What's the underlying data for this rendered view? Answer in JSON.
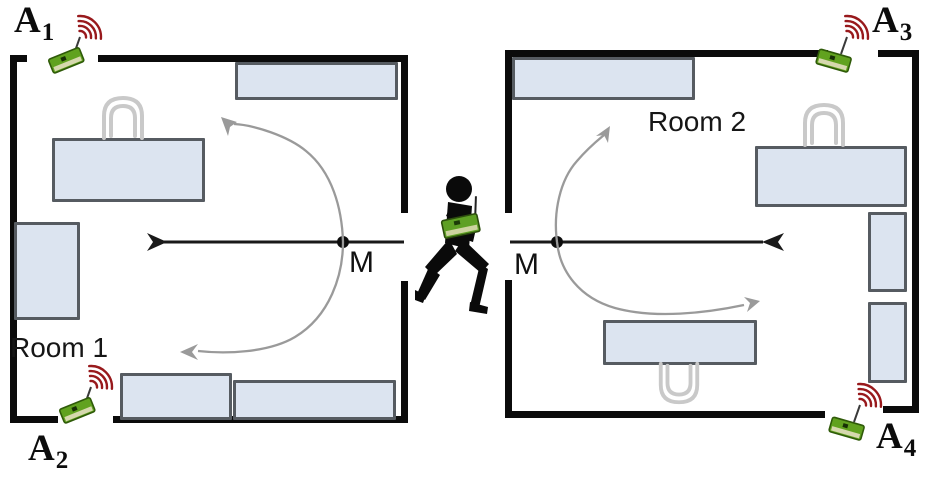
{
  "rooms": [
    {
      "label": "Room 1"
    },
    {
      "label": "Room 2"
    }
  ],
  "anchors": [
    {
      "name": "A1",
      "label": "A",
      "sub": "1"
    },
    {
      "name": "A2",
      "label": "A",
      "sub": "2"
    },
    {
      "name": "A3",
      "label": "A",
      "sub": "3"
    },
    {
      "name": "A4",
      "label": "A",
      "sub": "4"
    }
  ],
  "measurement_points": [
    {
      "label": "M",
      "room": "Room 1"
    },
    {
      "label": "M",
      "room": "Room 2"
    }
  ],
  "colors": {
    "wall": "#0b0b0b",
    "furniture_fill": "#dce4f0",
    "furniture_border": "#565b61",
    "chair_outline": "#cccccc",
    "axis_line": "#1a1a1a",
    "trajectory": "#9a9a9a",
    "anchor_board_green": "#61a21f",
    "radio_wave_red": "#98191c",
    "person_silhouette": "#0a0a0a"
  }
}
